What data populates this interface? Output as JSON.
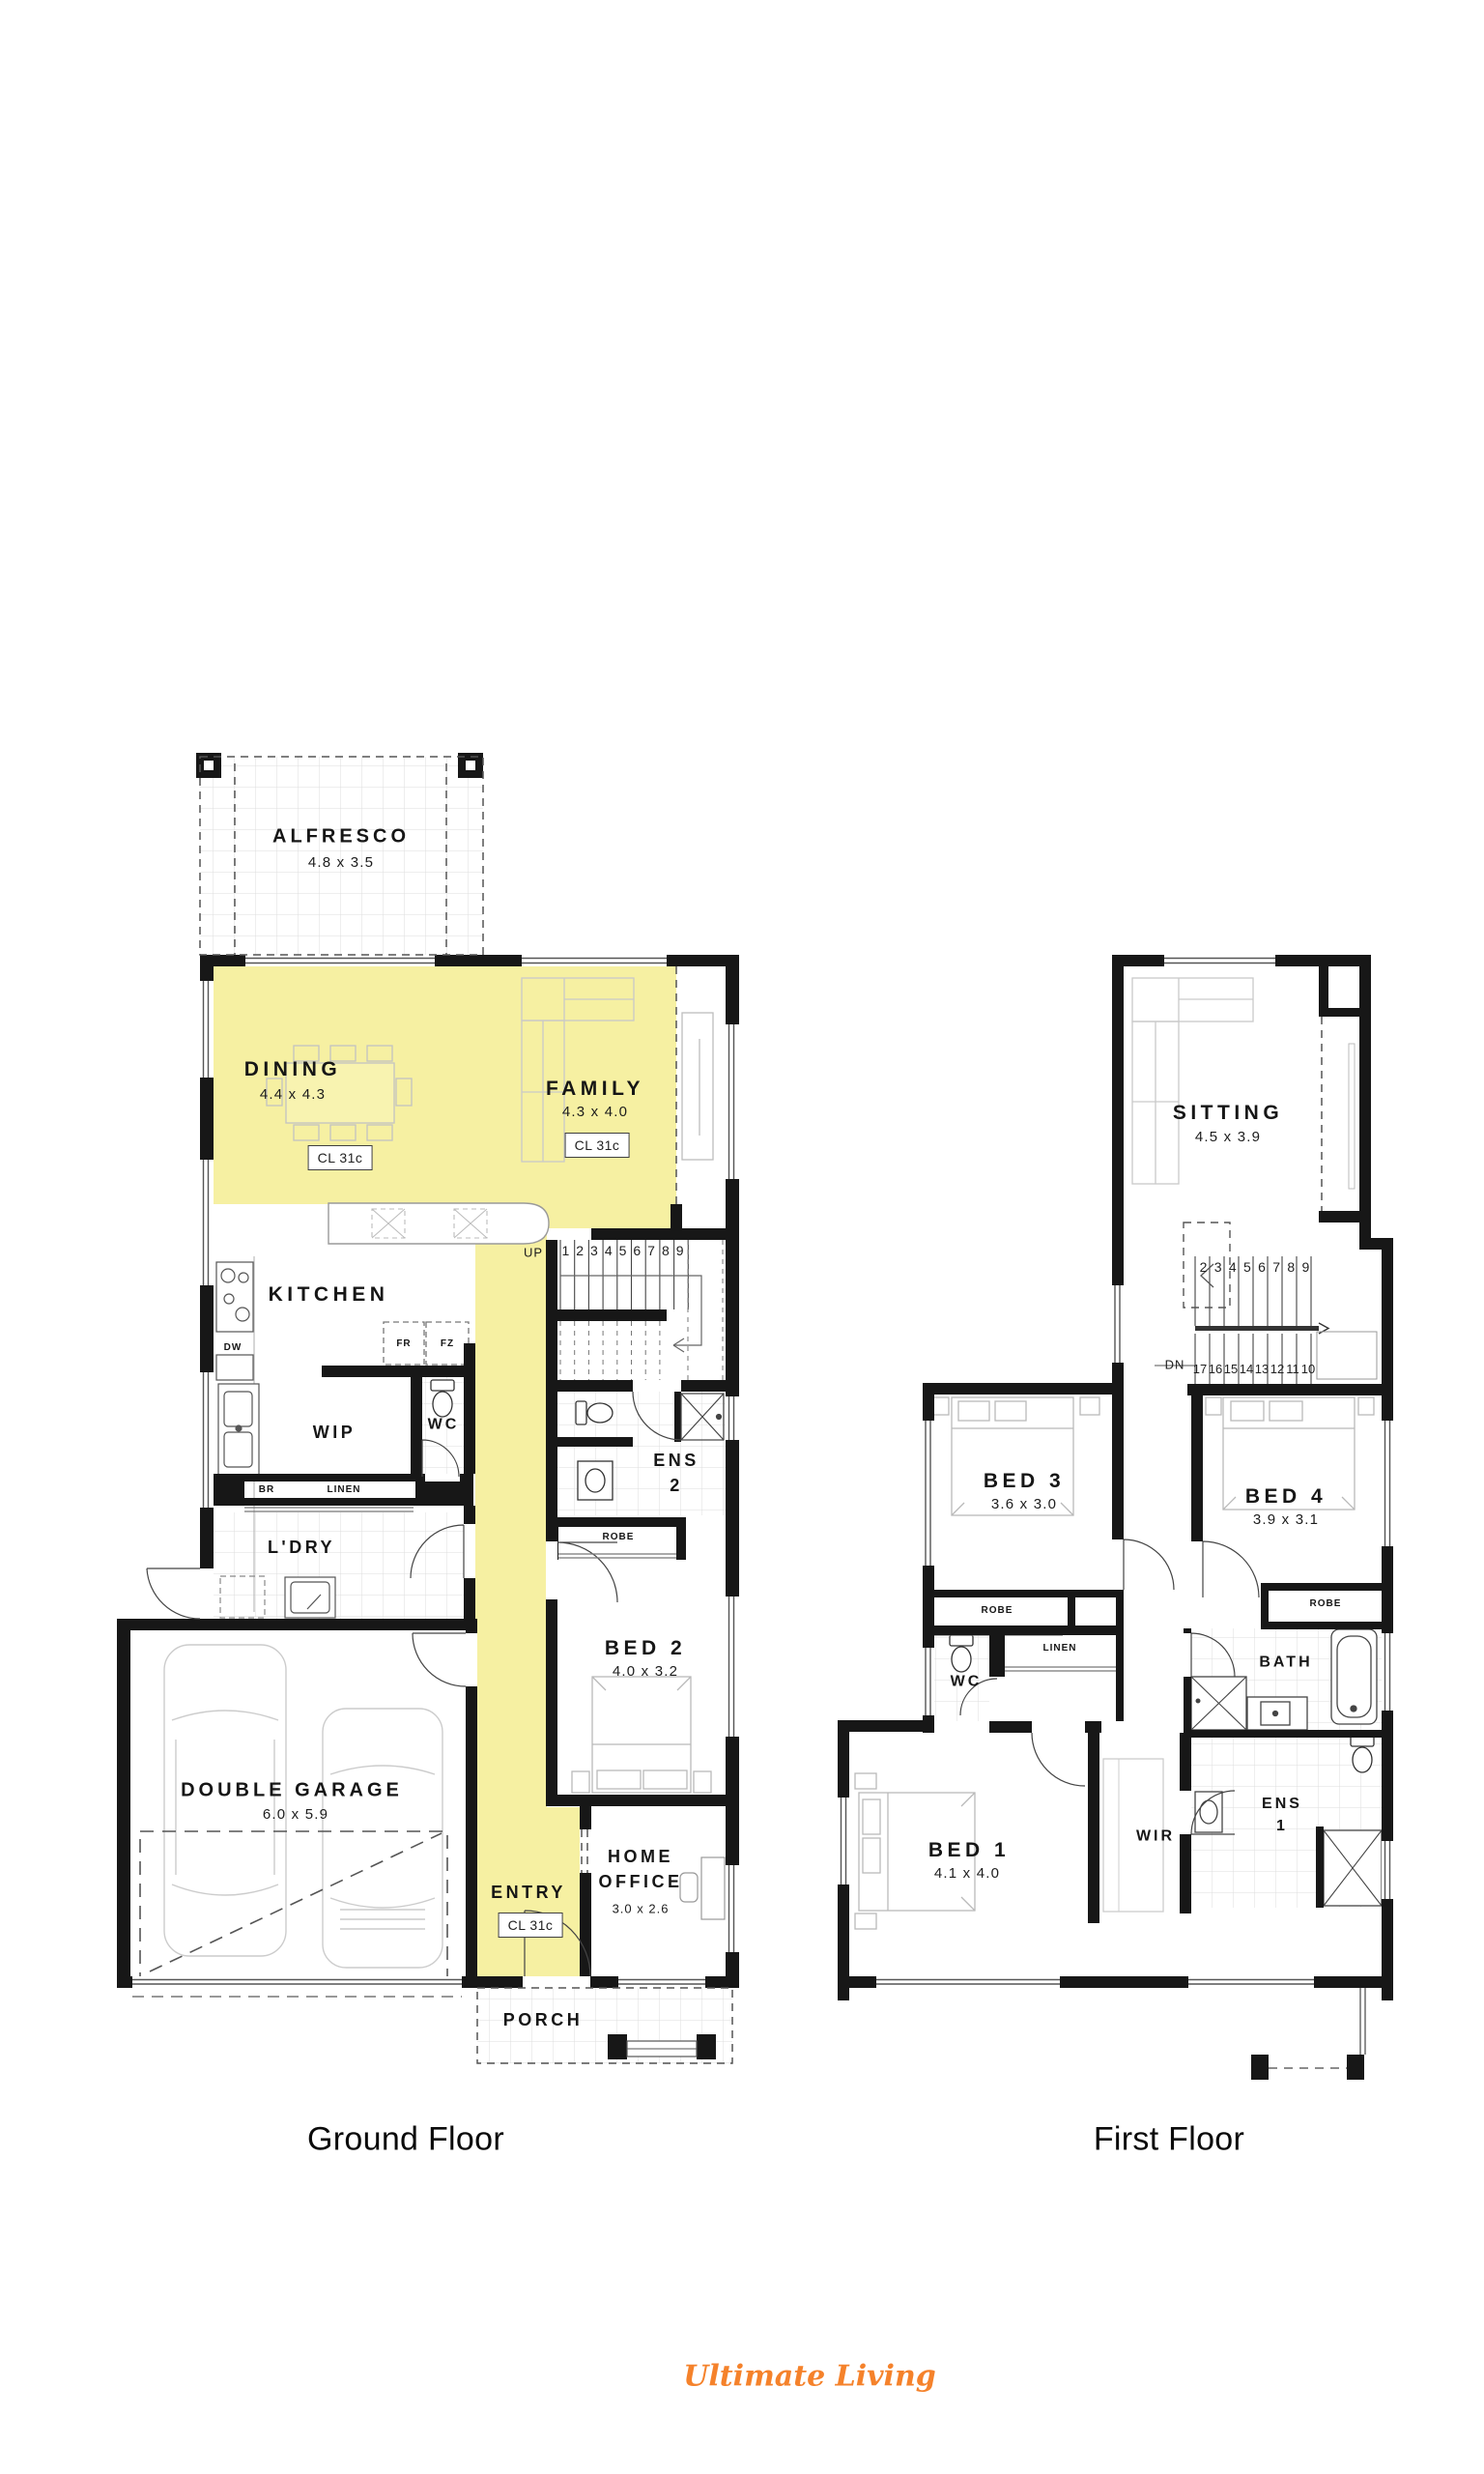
{
  "palette": {
    "highlight": "#F6F0A2",
    "wall": "#171717",
    "logo_orange": "#F5822B"
  },
  "captions": {
    "ground": "Ground Floor",
    "first": "First Floor"
  },
  "brand": {
    "logo_text": "Ultimate Living"
  },
  "ground": {
    "alfresco": {
      "name": "ALFRESCO",
      "dims": "4.8 x 3.5"
    },
    "dining": {
      "name": "DINING",
      "dims": "4.4 x 4.3",
      "ceiling": "CL 31c"
    },
    "family": {
      "name": "FAMILY",
      "dims": "4.3 x 4.0",
      "ceiling": "CL 31c"
    },
    "kitchen": {
      "name": "KITCHEN"
    },
    "appliances": {
      "fr": "FR",
      "fz": "FZ",
      "dw": "DW"
    },
    "wip": {
      "name": "WIP"
    },
    "wc": {
      "name": "WC"
    },
    "cupboards": {
      "br": "BR",
      "linen": "LINEN"
    },
    "ldry": {
      "name": "L'DRY"
    },
    "garage": {
      "name": "DOUBLE GARAGE",
      "dims": "6.0 x 5.9"
    },
    "stairs": {
      "up": "UP",
      "numbers": [
        "1",
        "2",
        "3",
        "4",
        "5",
        "6",
        "7",
        "8",
        "9"
      ]
    },
    "ens2": {
      "name": "ENS\n2"
    },
    "robe": {
      "name": "ROBE"
    },
    "bed2": {
      "name": "BED 2",
      "dims": "4.0 x 3.2"
    },
    "entry": {
      "name": "ENTRY",
      "ceiling": "CL 31c"
    },
    "home_office": {
      "name": "HOME\nOFFICE",
      "dims": "3.0 x 2.6"
    },
    "porch": {
      "name": "PORCH"
    }
  },
  "first": {
    "sitting": {
      "name": "SITTING",
      "dims": "4.5 x 3.9"
    },
    "stairs": {
      "dn": "DN",
      "upper_numbers": [
        "2",
        "3",
        "4",
        "5",
        "6",
        "7",
        "8",
        "9"
      ],
      "lower_numbers": [
        "17",
        "16",
        "15",
        "14",
        "13",
        "12",
        "11",
        "10"
      ]
    },
    "bed3": {
      "name": "BED 3",
      "dims": "3.6 x 3.0"
    },
    "bed4": {
      "name": "BED 4",
      "dims": "3.9 x 3.1"
    },
    "robe3": {
      "name": "ROBE"
    },
    "robe4": {
      "name": "ROBE"
    },
    "linen": {
      "name": "LINEN"
    },
    "wc": {
      "name": "WC"
    },
    "bath": {
      "name": "BATH"
    },
    "ens1": {
      "name": "ENS\n1"
    },
    "wir": {
      "name": "WIR"
    },
    "bed1": {
      "name": "BED 1",
      "dims": "4.1 x 4.0"
    }
  }
}
